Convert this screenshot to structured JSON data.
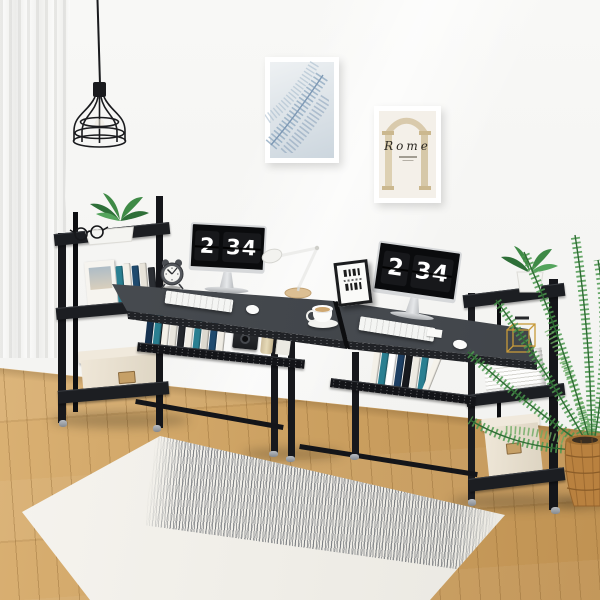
{
  "meta": {
    "scene": "Home office lifestyle product photo: two black computer desks with attached shelf towers",
    "image_type": "product photograph"
  },
  "palette": {
    "wall": "#f6f6f4",
    "floor_wood": "#cda263",
    "furniture_black": "#1a1b1e",
    "desk_surface": "#43474b",
    "rug": "#f3f1eb",
    "plant_green": "#3f8a46",
    "basket": "#b9813f",
    "gold_accent": "#c79a3a",
    "box_fabric": "#e9e1d2"
  },
  "wall_art": {
    "leaf_print": {
      "name": "palm leaf art print",
      "frame_color": "#ffffff"
    },
    "rome_print": {
      "title": "Rome",
      "frame_color": "#ffffff"
    }
  },
  "monitors": {
    "left": {
      "hour": "2",
      "minute": "34",
      "marker": "·"
    },
    "right": {
      "hour": "2",
      "minute": "34",
      "marker": "·"
    }
  },
  "objects": {
    "pendant_lamp": "black wire cage pendant lamp",
    "curtain": "white sheer curtain",
    "left_tower": {
      "top_shelf": [
        "potted plant",
        "eyeglasses"
      ],
      "middle_shelf": "books and postcard book",
      "lower_shelf": "beige fabric storage box"
    },
    "left_desk": [
      "twin-bell alarm clock",
      "monitor with flip clock",
      "white keyboard",
      "white mouse",
      "under-shelf books",
      "camera",
      "vacuum flask",
      "white bookend",
      "coffee cup",
      "white desk lamp"
    ],
    "right_desk": [
      "mini art print",
      "monitor with flip clock",
      "white keyboard",
      "white mouse",
      "under-shelf books",
      "paper note"
    ],
    "right_tower": {
      "top_shelf": "potted plant",
      "middle_shelf": [
        "gold wire ornament",
        "white magazine stack"
      ],
      "lower_shelf": "beige fabric storage box"
    },
    "palm_plant": "palm plant in wicker basket",
    "rug": "cream area rug with scribbled stripe band",
    "floor": "light oak plank floor",
    "alarm_clock_hands": "10:10"
  },
  "books": {
    "tower_left": [
      {
        "c": "#2a7f91",
        "h": 44
      },
      {
        "c": "#f3f0e8",
        "h": 46
      },
      {
        "c": "#1f4a6e",
        "h": 43
      },
      {
        "c": "#e8e4da",
        "h": 45
      },
      {
        "c": "#2b2e33",
        "h": 40
      },
      {
        "c": "#efece4",
        "h": 44
      }
    ],
    "under_left": [
      {
        "c": "#16324f",
        "h": 40
      },
      {
        "c": "#2a7f91",
        "h": 42
      },
      {
        "c": "#f3f0e8",
        "h": 38
      },
      {
        "c": "#e8e5dc",
        "h": 40
      },
      {
        "c": "#23262b",
        "h": 41
      },
      {
        "c": "#f1eee6",
        "h": 37
      },
      {
        "c": "#2a7f91",
        "h": 40
      },
      {
        "c": "#dcd9cf",
        "h": 36
      },
      {
        "c": "#1f4a6e",
        "h": 41
      },
      {
        "c": "#efece4",
        "h": 39
      }
    ],
    "under_right": [
      {
        "c": "#f3f0e8",
        "h": 42
      },
      {
        "c": "#2a7f91",
        "h": 44
      },
      {
        "c": "#ffffff",
        "h": 40
      },
      {
        "c": "#1d3f63",
        "h": 43
      },
      {
        "c": "#17191d",
        "h": 41
      },
      {
        "c": "#edeae2",
        "h": 38
      },
      {
        "c": "#2a7f91",
        "h": 42
      },
      {
        "c": "#f5f2ea",
        "h": 40,
        "k": -14
      }
    ]
  }
}
